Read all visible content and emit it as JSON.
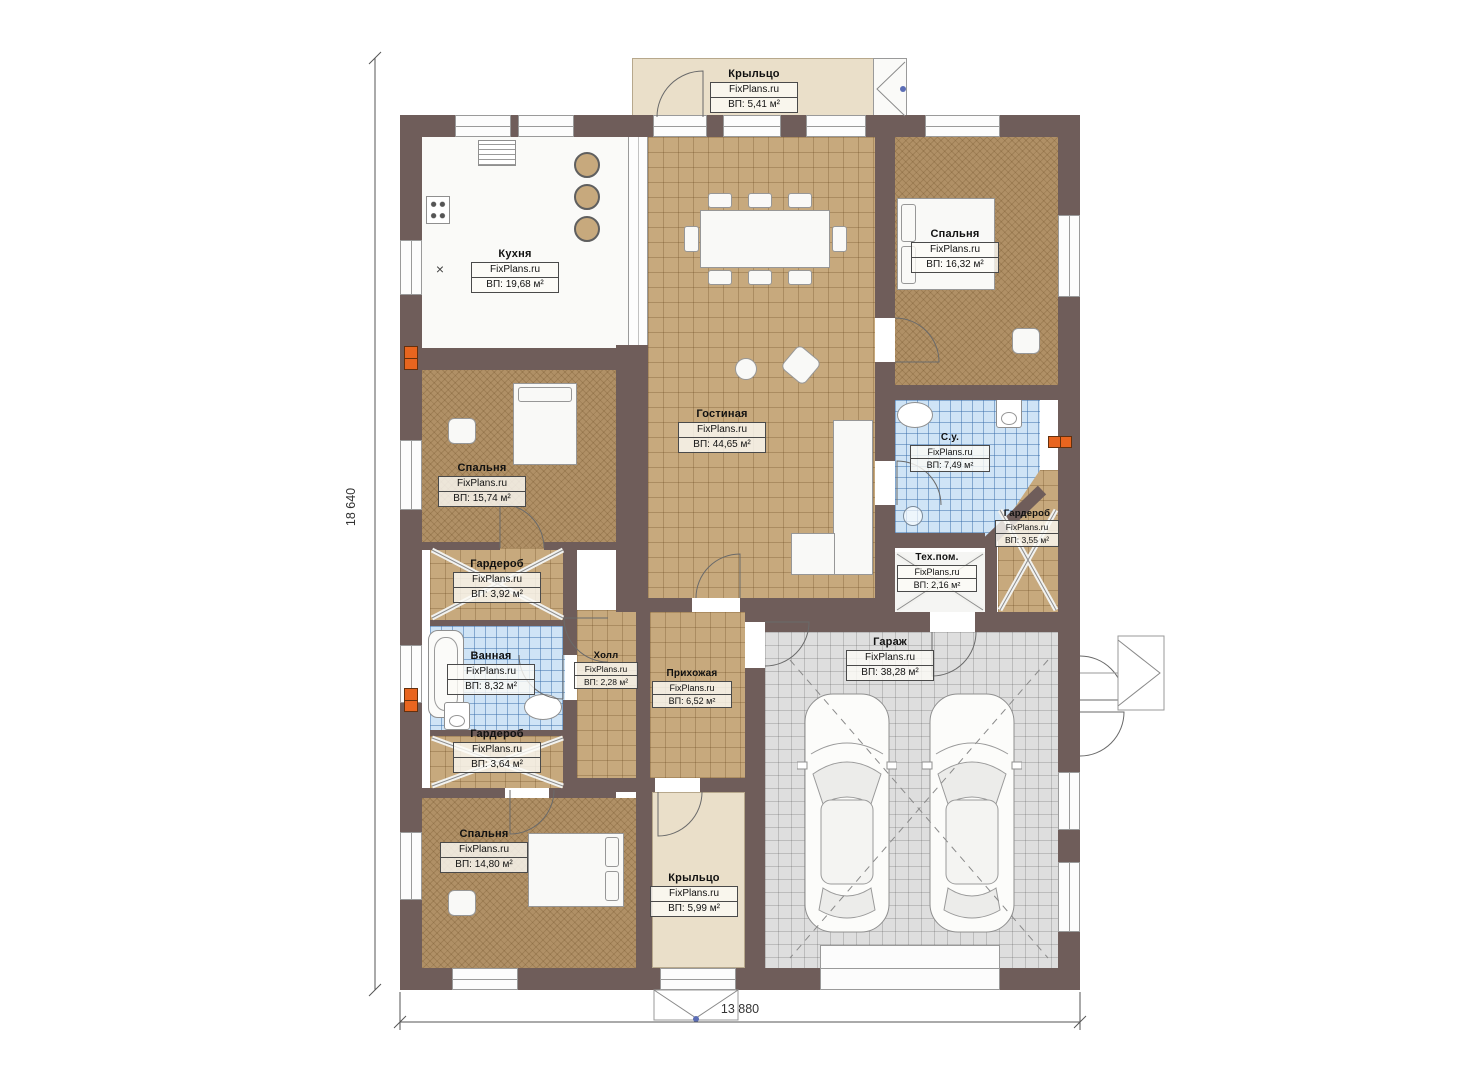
{
  "brand": "FixPlans.ru",
  "dimensions": {
    "height_label": "18 640",
    "width_label": "13 880"
  },
  "rooms": [
    {
      "name": "Крыльцо",
      "area": "ВП: 5,41 м²"
    },
    {
      "name": "Кухня",
      "area": "ВП: 19,68 м²"
    },
    {
      "name": "Гостиная",
      "area": "ВП: 44,65 м²"
    },
    {
      "name": "Спальня",
      "area": "ВП: 16,32 м²"
    },
    {
      "name": "С.у.",
      "area": "ВП: 7,49 м²"
    },
    {
      "name": "Гардероб",
      "area": "ВП: 3,55 м²"
    },
    {
      "name": "Тех.пом.",
      "area": "ВП: 2,16 м²"
    },
    {
      "name": "Спальня",
      "area": "ВП: 15,74 м²"
    },
    {
      "name": "Гардероб",
      "area": "ВП: 3,92 м²"
    },
    {
      "name": "Ванная",
      "area": "ВП: 8,32 м²"
    },
    {
      "name": "Холл",
      "area": "ВП: 2,28 м²"
    },
    {
      "name": "Прихожая",
      "area": "ВП: 6,52 м²"
    },
    {
      "name": "Гараж",
      "area": "ВП: 38,28 м²"
    },
    {
      "name": "Гардероб",
      "area": "ВП: 3,64 м²"
    },
    {
      "name": "Спальня",
      "area": "ВП: 14,80 м²"
    },
    {
      "name": "Крыльцо",
      "area": "ВП: 5,99 м²"
    }
  ],
  "colors": {
    "wall": "#6f5d5a",
    "floor_tile": "#c7a97d",
    "bedroom_carpet": "#b09066",
    "bath_tile": "#cfe4f6",
    "garage_tile": "#dedede",
    "porch": "#eadfc9",
    "radiator": "#e8651f",
    "dimension_text": "#333333"
  }
}
